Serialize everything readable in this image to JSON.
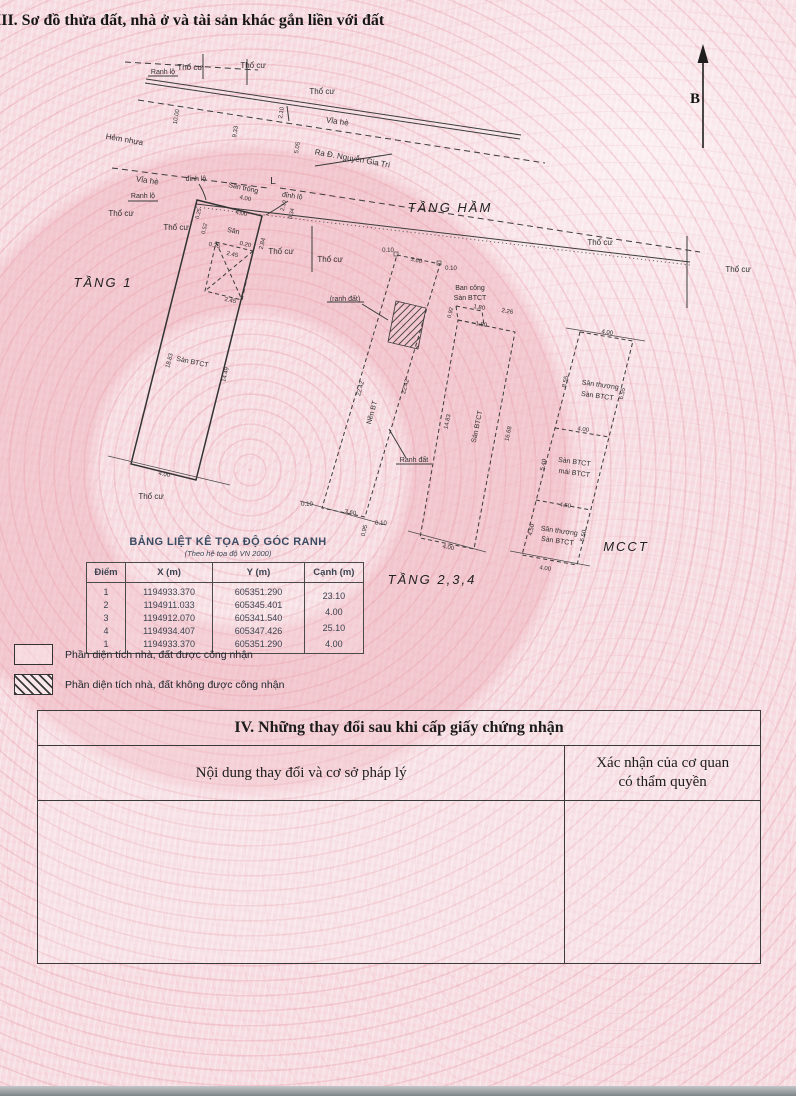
{
  "header": {
    "section3_title": "III. Sơ đồ thửa đất, nhà ở và tài sản khác gắn liền với đất"
  },
  "compass": {
    "north": "B"
  },
  "diagram": {
    "floor_labels": {
      "tang1": "TẦNG 1",
      "tang_ham": "TẦNG HẦM",
      "tang234": "TẦNG 2,3,4",
      "mcct": "MCCT"
    },
    "streets": {
      "tho_cu": "Thổ cư",
      "ranh_lo": "Ranh lộ",
      "via_he": "Vỉa hè",
      "hem_nhua": "Hẻm nhựa",
      "ra_duong": "Ra Đ. Nguyễn Gia Trí",
      "dinh_lo": "đỉnh lộ",
      "san_trong": "Sân trống",
      "l_mark": "L",
      "ranh_dat": "Ranh đất",
      "ranh_dat_paren": "(ranh đất)"
    },
    "features": {
      "san": "Sân",
      "san_btct": "Sàn BTCT",
      "nen_bt": "Nền BT",
      "ban_cong": "Ban công",
      "san_thuong": "Sân thượng",
      "mai_btct": "mái BTCT"
    },
    "dims": {
      "d400": "4.00",
      "d210": "2.10",
      "d1000": "10.00",
      "d933": "9.33",
      "d505": "5.05",
      "d035": "0.35",
      "d020": "0.20",
      "d245": "2.45",
      "d1883": "18.83",
      "d1449": "14.49",
      "d284": "2.84",
      "d034": "0.34",
      "d025": "0.25",
      "d052": "0.52",
      "d010": "0.10",
      "d360": "3.60",
      "d2242": "22.42",
      "d095": "0.95",
      "d180": "1.80",
      "d226": "2.26",
      "d092": "0.92",
      "d1483": "14.83",
      "d1668": "16.68",
      "d655": "6.55",
      "d855": "8.55",
      "d540": "5.40",
      "d450": "4.50",
      "d550": "5.50"
    }
  },
  "coord_table": {
    "title": "BẢNG LIỆT KÊ TỌA ĐỘ GÓC RANH",
    "subtitle": "(Theo hệ tọa độ VN 2000)",
    "headers": [
      "Điểm",
      "X (m)",
      "Y (m)",
      "Cạnh (m)"
    ],
    "rows": [
      {
        "diem": "1",
        "x": "1194933.370",
        "y": "605351.290",
        "canh": "23.10"
      },
      {
        "diem": "2",
        "x": "1194911.033",
        "y": "605345.401",
        "canh": "4.00"
      },
      {
        "diem": "3",
        "x": "1194912.070",
        "y": "605341.540",
        "canh": "25.10"
      },
      {
        "diem": "4",
        "x": "1194934.407",
        "y": "605347.426",
        "canh": "4.00"
      },
      {
        "diem": "1",
        "x": "1194933.370",
        "y": "605351.290",
        "canh": ""
      }
    ]
  },
  "legend": {
    "recognized": "Phần diện tích nhà, đất được công nhận",
    "not_recognized": "Phần diện tích nhà, đất không được công nhận"
  },
  "section4": {
    "title": "IV. Những thay đổi sau khi cấp giấy chứng nhận",
    "col1": "Nội dung thay đổi và cơ sở pháp lý",
    "col2_line1": "Xác nhận của cơ quan",
    "col2_line2": "có thẩm quyền"
  }
}
